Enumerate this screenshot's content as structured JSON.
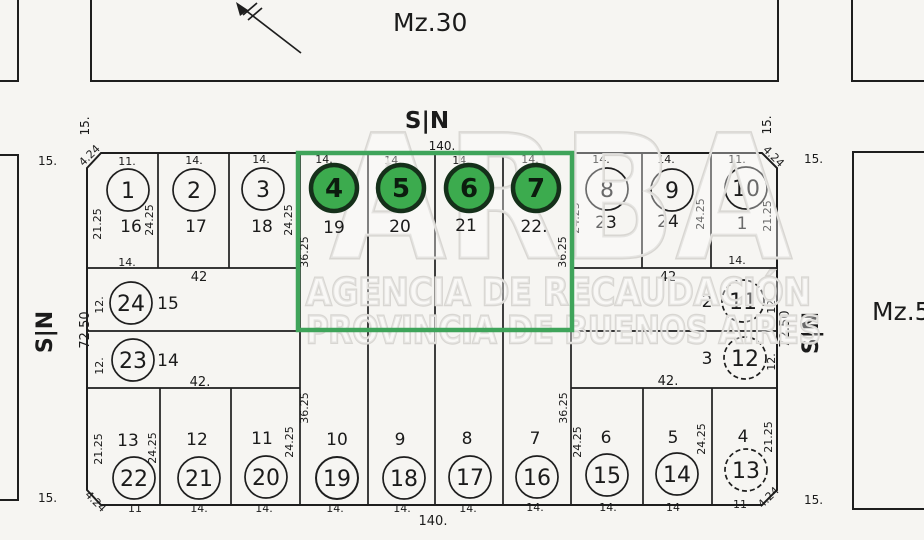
{
  "blocks": {
    "top": "Mz.30",
    "right": "Mz.5"
  },
  "streets": {
    "top": {
      "name": "S|N",
      "frontage": "140."
    },
    "bottom": {
      "frontage": "140."
    },
    "left": {
      "name": "S|N",
      "depth": "72.50",
      "w_top": "15.",
      "w_bottom": "15."
    },
    "right": {
      "name": "S|N",
      "depth": "72.50",
      "w_top": "15.",
      "w_bottom": "15."
    },
    "corner_tl": "15.",
    "corner_tr": "15."
  },
  "watermark": {
    "brand": "ARBA",
    "line1": "AGENCIA DE RECAUDACIÓN",
    "line2": "PROVINCIA DE BUENOS AIRES"
  },
  "dims": {
    "chamfer": "4.24",
    "side": "21.25",
    "d24": "24.25",
    "d36": "36.25",
    "strip": "12.",
    "w42": "42",
    "w42b": "42."
  },
  "lots": {
    "top_left": [
      {
        "num": "1",
        "parcel": "16",
        "front": "11."
      },
      {
        "num": "2",
        "parcel": "17",
        "front": "14."
      },
      {
        "num": "3",
        "parcel": "18",
        "front": "14."
      }
    ],
    "top_center": [
      {
        "num": "4",
        "parcel": "19",
        "front": "14."
      },
      {
        "num": "5",
        "parcel": "20",
        "front": "14."
      },
      {
        "num": "6",
        "parcel": "21",
        "front": "14."
      },
      {
        "num": "7",
        "parcel": "22.",
        "front": "14."
      }
    ],
    "top_right": [
      {
        "num": "8",
        "parcel": "23",
        "front": "14."
      },
      {
        "num": "9",
        "parcel": "24",
        "front": "14."
      },
      {
        "num": "10",
        "parcel": "1",
        "front": "11."
      }
    ],
    "lot1_rear": "14.",
    "lot10_rear": "14.",
    "mid_left": [
      {
        "num": "24",
        "parcel": "15",
        "side": "12."
      },
      {
        "num": "23",
        "parcel": "14",
        "side": "12."
      }
    ],
    "mid_right": [
      {
        "num": "11",
        "parcel": "2",
        "side": "12."
      },
      {
        "num": "12",
        "parcel": "3",
        "side": "12."
      }
    ],
    "bottom_left": [
      {
        "num": "22",
        "parcel": "13",
        "front": "11"
      },
      {
        "num": "21",
        "parcel": "12",
        "front": "14."
      },
      {
        "num": "20",
        "parcel": "11",
        "front": "14."
      }
    ],
    "bottom_center": [
      {
        "num": "19",
        "parcel": "10",
        "front": "14."
      },
      {
        "num": "18",
        "parcel": "9",
        "front": "14."
      },
      {
        "num": "17",
        "parcel": "8",
        "front": "14."
      },
      {
        "num": "16",
        "parcel": "7",
        "front": "14."
      }
    ],
    "bottom_right": [
      {
        "num": "15",
        "parcel": "6",
        "front": "14."
      },
      {
        "num": "14",
        "parcel": "5",
        "front": "14"
      },
      {
        "num": "13",
        "parcel": "4",
        "front": "11"
      }
    ]
  },
  "highlight": {
    "selected_lots": "4 5 6 7",
    "color": "#3fa45a"
  }
}
